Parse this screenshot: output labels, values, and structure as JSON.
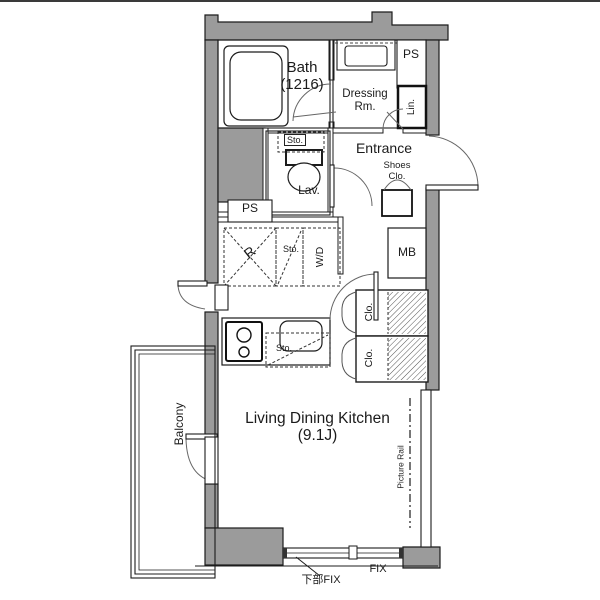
{
  "colors": {
    "wall": "#9b9b9b",
    "line": "#1c1c1c",
    "arc": "#666666",
    "background": "#ffffff"
  },
  "rooms": {
    "bath": {
      "name": "Bath",
      "size": "(1216)"
    },
    "dressing": {
      "line1": "Dressing",
      "line2": "Rm."
    },
    "lavatory": {
      "label": "Lav."
    },
    "entrance": {
      "label": "Entrance"
    },
    "ldk": {
      "name": "Living Dining Kitchen",
      "size": "(9.1J)"
    },
    "balcony": {
      "label": "Balcony"
    }
  },
  "fixtures": {
    "ps_top": "PS",
    "ps_mid": "PS",
    "linen": "Lin.",
    "sto_toilet": "Sto.",
    "shoes_line1": "Shoes",
    "shoes_line2": "Clo.",
    "refrigerator": "R",
    "sto_mid": "Sto.",
    "washer_dryer": "W/D",
    "meter_box": "MB",
    "closet_upper": "Clo.",
    "closet_lower": "Clo.",
    "sto_kitchen": "Sto.",
    "picture_rail": "Picture Rail"
  },
  "windows": {
    "fix": "FIX",
    "lower_fix": "下部FIX"
  }
}
